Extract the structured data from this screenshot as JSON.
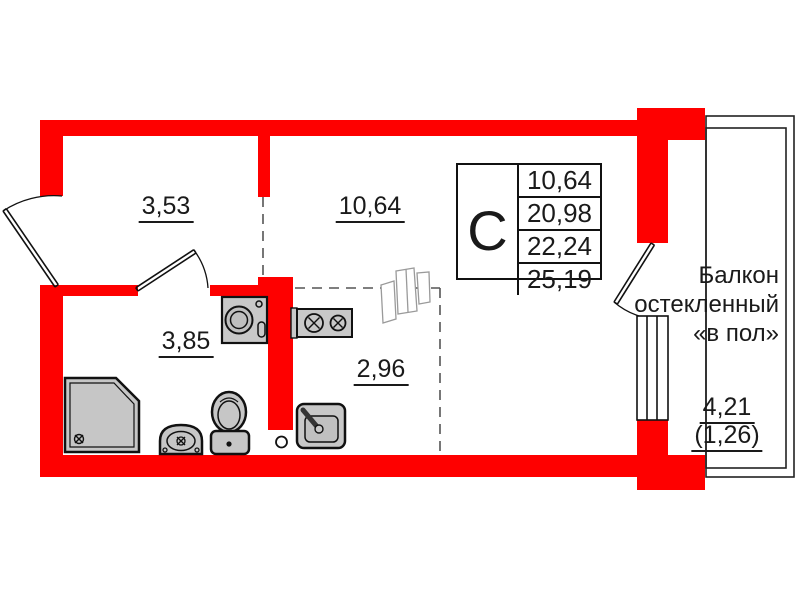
{
  "plan": {
    "title": "Studio apartment floor plan",
    "rooms": [
      {
        "id": "hallway",
        "area": "3,53"
      },
      {
        "id": "living-room",
        "area": "10,64"
      },
      {
        "id": "bathroom",
        "area": "3,85"
      },
      {
        "id": "kitchen-niche",
        "area": "2,96"
      }
    ],
    "balcony": {
      "label_lines": [
        "Балкон",
        "остекленный",
        "«в пол»"
      ],
      "area": "4,21",
      "area_with_coefficient": "(1,26)"
    },
    "info_table": {
      "type_letter": "С",
      "rows": [
        "10,64",
        "20,98",
        "22,24",
        "25,19"
      ]
    },
    "fixtures": [
      "entrance-door",
      "bathroom-door",
      "balcony-door",
      "balcony-window",
      "shower-tray",
      "bathroom-sink",
      "toilet",
      "washing-machine",
      "stove",
      "kitchen-sink",
      "wardrobe-sketch",
      "ventilation-shaft"
    ],
    "colors": {
      "wall": "#fe0000",
      "fixture_fill": "#c6c6c6",
      "line": "#111111",
      "dashed_line": "#555555"
    }
  }
}
